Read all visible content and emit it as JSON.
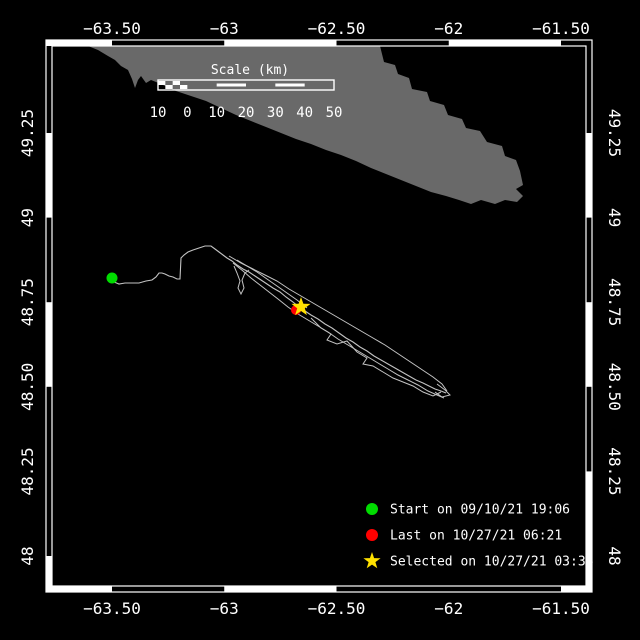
{
  "colors": {
    "background": "#000000",
    "frame": "#ffffff",
    "island": "#696969",
    "track": "#c3c3c3",
    "start_marker": "#00dc00",
    "last_marker": "#ff0000",
    "selected_marker": "#ffe100",
    "text": "#ffffff"
  },
  "axes": {
    "lon": {
      "labels": [
        "−63.50",
        "−63",
        "−62.50",
        "−62",
        "−61.50"
      ],
      "x_px": [
        112,
        224.25,
        336.5,
        448.75,
        561
      ]
    },
    "lat": {
      "labels": [
        "49.25",
        "49",
        "48.75",
        "48.50",
        "48.25",
        "48"
      ],
      "y_px": [
        133,
        217.6,
        302.2,
        386.8,
        471.4,
        556
      ]
    }
  },
  "frame": {
    "outer": [
      46,
      40,
      592,
      592
    ],
    "inner": [
      52,
      46,
      586,
      586
    ],
    "band_colors": {
      "top": [
        "W",
        "B",
        "W",
        "B",
        "W",
        "B"
      ],
      "bottom": [
        "W",
        "B",
        "W",
        "B",
        "B",
        "W"
      ],
      "left": [
        "B",
        "W",
        "B",
        "W",
        "B",
        "B",
        "W"
      ],
      "right": [
        "B",
        "W",
        "B",
        "W",
        "B",
        "W",
        "W"
      ]
    }
  },
  "scale_bar": {
    "title": "Scale (km)",
    "labels": [
      "10",
      "0",
      "10",
      "20",
      "30",
      "40",
      "50"
    ],
    "x": 158,
    "y": 80,
    "w": 176,
    "h": 10,
    "title_x": 250,
    "title_y": 74,
    "labels_y": 117,
    "segments": [
      "checker",
      "solid",
      "striped",
      "solid",
      "striped",
      "solid"
    ]
  },
  "legend": {
    "x_marker": 372,
    "x_text": 390,
    "y_start": 509,
    "dy": 26,
    "entries": [
      {
        "marker": "circle",
        "color": "#00dc00",
        "label": "Start on 09/10/21 19:06"
      },
      {
        "marker": "circle",
        "color": "#ff0000",
        "label": "Last on 10/27/21 06:21"
      },
      {
        "marker": "star",
        "color": "#ffe100",
        "label": "Selected on 10/27/21 03:36"
      }
    ]
  },
  "map_data": {
    "type": "track-map",
    "region": {
      "lon_min": -63.79,
      "lon_max": -61.36,
      "lat_min": 47.89,
      "lat_max": 49.53
    },
    "island": [
      [
        88,
        46
      ],
      [
        380,
        46
      ],
      [
        384,
        62
      ],
      [
        395,
        65
      ],
      [
        398,
        74
      ],
      [
        409,
        78
      ],
      [
        412,
        89
      ],
      [
        427,
        92
      ],
      [
        430,
        101
      ],
      [
        444,
        105
      ],
      [
        448,
        115
      ],
      [
        462,
        119
      ],
      [
        466,
        128
      ],
      [
        480,
        131
      ],
      [
        487,
        142
      ],
      [
        502,
        146
      ],
      [
        505,
        156
      ],
      [
        516,
        160
      ],
      [
        520,
        171
      ],
      [
        523,
        185
      ],
      [
        516,
        189
      ],
      [
        523,
        196
      ],
      [
        517,
        202
      ],
      [
        505,
        200
      ],
      [
        495,
        204
      ],
      [
        481,
        200
      ],
      [
        471,
        204
      ],
      [
        459,
        200
      ],
      [
        446,
        196
      ],
      [
        431,
        192
      ],
      [
        416,
        186
      ],
      [
        401,
        180
      ],
      [
        386,
        174
      ],
      [
        371,
        168
      ],
      [
        356,
        161
      ],
      [
        341,
        155
      ],
      [
        326,
        150
      ],
      [
        311,
        144
      ],
      [
        296,
        139
      ],
      [
        281,
        133
      ],
      [
        266,
        127
      ],
      [
        251,
        121
      ],
      [
        236,
        115
      ],
      [
        221,
        108
      ],
      [
        206,
        101
      ],
      [
        191,
        96
      ],
      [
        176,
        91
      ],
      [
        161,
        84
      ],
      [
        151,
        80
      ],
      [
        146,
        83
      ],
      [
        141,
        76
      ],
      [
        138,
        80
      ],
      [
        135,
        88
      ],
      [
        132,
        79
      ],
      [
        128,
        70
      ],
      [
        121,
        66
      ],
      [
        115,
        60
      ],
      [
        108,
        56
      ],
      [
        98,
        50
      ]
    ],
    "track_main": [
      [
        112,
        278
      ],
      [
        114,
        282
      ],
      [
        119,
        284
      ],
      [
        125,
        283
      ],
      [
        132,
        283
      ],
      [
        139,
        283
      ],
      [
        146,
        281
      ],
      [
        152,
        280
      ],
      [
        156,
        277
      ],
      [
        159,
        273
      ],
      [
        162,
        273
      ],
      [
        165,
        274
      ],
      [
        169,
        276
      ],
      [
        173,
        277
      ],
      [
        177,
        279
      ],
      [
        180,
        279
      ],
      [
        181,
        258
      ],
      [
        184,
        255
      ],
      [
        188,
        252
      ],
      [
        193,
        250
      ],
      [
        199,
        248
      ],
      [
        205,
        246
      ],
      [
        211,
        246
      ],
      [
        215,
        249
      ],
      [
        219,
        252
      ],
      [
        223,
        255
      ],
      [
        227,
        258
      ],
      [
        232,
        261
      ],
      [
        237,
        265
      ],
      [
        243,
        269
      ],
      [
        249,
        272
      ],
      [
        255,
        276
      ],
      [
        261,
        280
      ],
      [
        267,
        284
      ],
      [
        273,
        288
      ],
      [
        280,
        292
      ],
      [
        286,
        297
      ],
      [
        293,
        302
      ],
      [
        299,
        307
      ],
      [
        305,
        311
      ],
      [
        311,
        315
      ],
      [
        318,
        319
      ],
      [
        325,
        324
      ],
      [
        332,
        328
      ],
      [
        339,
        333
      ],
      [
        346,
        338
      ],
      [
        353,
        342
      ],
      [
        360,
        347
      ],
      [
        367,
        351
      ],
      [
        374,
        356
      ],
      [
        381,
        360
      ],
      [
        388,
        364
      ],
      [
        395,
        368
      ],
      [
        402,
        372
      ],
      [
        409,
        376
      ],
      [
        416,
        380
      ],
      [
        423,
        383
      ],
      [
        429,
        386
      ],
      [
        435,
        389
      ],
      [
        441,
        391
      ],
      [
        446,
        393
      ]
    ],
    "track_strands": [
      [
        [
          229,
          256
        ],
        [
          241,
          263
        ],
        [
          253,
          269
        ],
        [
          265,
          275
        ],
        [
          277,
          281
        ],
        [
          289,
          289
        ],
        [
          301,
          296
        ],
        [
          313,
          303
        ],
        [
          325,
          310
        ],
        [
          337,
          317
        ],
        [
          349,
          324
        ],
        [
          361,
          331
        ],
        [
          373,
          338
        ],
        [
          385,
          345
        ],
        [
          397,
          353
        ],
        [
          409,
          361
        ],
        [
          421,
          369
        ],
        [
          433,
          377
        ],
        [
          442,
          384
        ],
        [
          447,
          391
        ]
      ],
      [
        [
          233,
          263
        ],
        [
          243,
          271
        ],
        [
          251,
          278
        ],
        [
          260,
          285
        ],
        [
          269,
          292
        ],
        [
          278,
          299
        ],
        [
          288,
          307
        ],
        [
          298,
          314
        ],
        [
          308,
          320
        ],
        [
          318,
          326
        ],
        [
          328,
          332
        ],
        [
          338,
          339
        ],
        [
          348,
          345
        ],
        [
          358,
          351
        ],
        [
          368,
          357
        ],
        [
          378,
          363
        ],
        [
          388,
          369
        ],
        [
          398,
          375
        ],
        [
          408,
          380
        ],
        [
          418,
          385
        ],
        [
          428,
          391
        ],
        [
          437,
          395
        ],
        [
          444,
          398
        ]
      ],
      [
        [
          234,
          266
        ],
        [
          237,
          273
        ],
        [
          240,
          281
        ],
        [
          238,
          288
        ],
        [
          241,
          294
        ],
        [
          244,
          288
        ],
        [
          242,
          280
        ],
        [
          245,
          273
        ],
        [
          249,
          270
        ]
      ],
      [
        [
          311,
          318
        ],
        [
          321,
          328
        ],
        [
          331,
          334
        ],
        [
          327,
          340
        ],
        [
          337,
          344
        ],
        [
          347,
          341
        ],
        [
          357,
          352
        ],
        [
          367,
          358
        ],
        [
          363,
          364
        ],
        [
          373,
          366
        ],
        [
          383,
          372
        ],
        [
          393,
          378
        ],
        [
          403,
          382
        ],
        [
          413,
          386
        ],
        [
          423,
          392
        ],
        [
          433,
          396
        ],
        [
          441,
          392
        ]
      ],
      [
        [
          237,
          260
        ],
        [
          247,
          266
        ],
        [
          257,
          272
        ],
        [
          267,
          279
        ],
        [
          277,
          286
        ],
        [
          287,
          293
        ],
        [
          297,
          300
        ],
        [
          307,
          308
        ]
      ],
      [
        [
          437,
          384
        ],
        [
          445,
          390
        ],
        [
          450,
          395
        ],
        [
          442,
          397
        ],
        [
          435,
          392
        ]
      ]
    ],
    "markers": {
      "start": {
        "x": 112,
        "y": 278
      },
      "last": {
        "x": 296,
        "y": 310
      },
      "selected": {
        "x": 301,
        "y": 307
      }
    }
  }
}
